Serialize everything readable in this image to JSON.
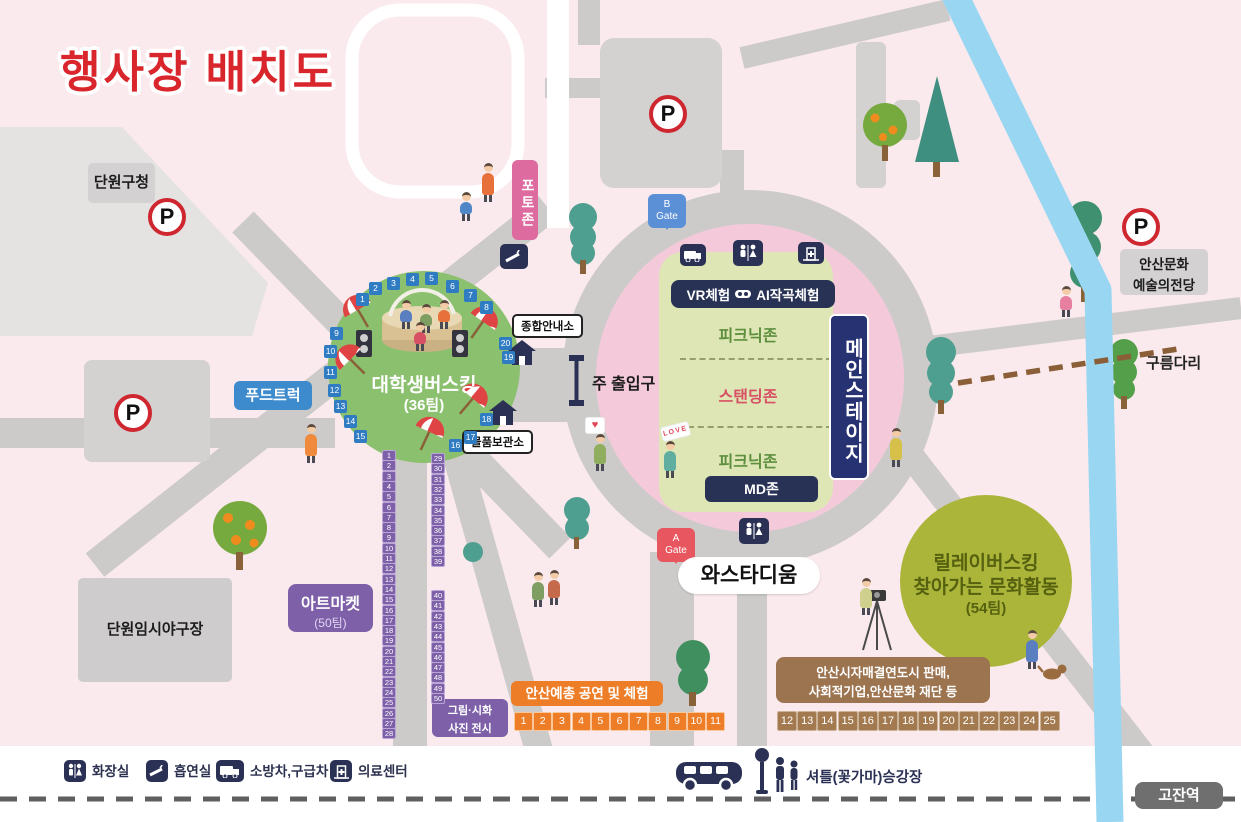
{
  "title": "행사장 배치도",
  "buildings": {
    "district_office": "단원구청",
    "baseball_field": "단원임시야구장",
    "arts_center_line1": "안산문화",
    "arts_center_line2": "예술의전당",
    "gojan_station": "고잔역"
  },
  "parking": {
    "label": "P"
  },
  "gates": {
    "b": {
      "line1": "B",
      "line2": "Gate"
    },
    "a": {
      "line1": "A",
      "line2": "Gate"
    }
  },
  "stadium": {
    "name": "와스타디움",
    "main_stage": "메인스테이지",
    "vr_label_left": "VR체험",
    "vr_label_right": "AI작곡체험",
    "picnic_zone_top": "피크닉존",
    "standing_zone": "스탠딩존",
    "picnic_zone_bottom": "피크닉존",
    "md_zone": "MD존"
  },
  "busking": {
    "name": "대학생버스킹",
    "teams": "(36팀)"
  },
  "relay": {
    "line1": "릴레이버스킹",
    "line2": "찾아가는 문화활동",
    "line3": "(54팀)"
  },
  "facilities": {
    "photo_zone": "포토존",
    "info_booth": "종합안내소",
    "main_entrance": "주 출입구",
    "locker": "물품보관소",
    "food_truck": "푸드트럭",
    "art_market_line1": "아트마켓",
    "art_market_line2": "(50팀)",
    "exhibit_line1": "그림·시화",
    "exhibit_line2": "사진 전시",
    "yechong": "안산예총 공연 및 체험",
    "sister_city_line1": "안산시자매결연도시 판매,",
    "sister_city_line2": "사회적기업,안산문화 재단 등",
    "bridge": "구름다리",
    "shuttle": "셔틀(꽃가마)승강장"
  },
  "signs": {
    "heart": "♥",
    "love": "LOVE"
  },
  "legend": {
    "items": [
      {
        "icon": "toilet-icon",
        "label": "화장실"
      },
      {
        "icon": "smoking-icon",
        "label": "흡연실"
      },
      {
        "icon": "fire-ambulance-icon",
        "label": "소방차,구급차"
      },
      {
        "icon": "medical-center-icon",
        "label": "의료센터"
      }
    ]
  },
  "numbers": {
    "stage_blue": [
      1,
      2,
      3,
      4,
      5,
      6,
      7,
      8,
      9,
      10,
      11,
      12,
      13,
      14,
      15,
      16,
      17,
      18,
      19,
      20
    ],
    "purple_left": [
      1,
      2,
      3,
      4,
      5,
      6,
      7,
      8,
      9,
      10,
      11,
      12,
      13,
      14,
      15,
      16,
      17,
      18,
      19,
      20,
      21,
      22,
      23,
      24,
      25,
      26,
      27,
      28
    ],
    "purple_right_upper": [
      29,
      30,
      31,
      32,
      33,
      34,
      35,
      36,
      37,
      38,
      39
    ],
    "purple_right_lower": [
      40,
      41,
      42,
      43,
      44,
      45,
      46,
      47,
      48,
      49,
      50
    ],
    "orange_row": [
      1,
      2,
      3,
      4,
      5,
      6,
      7,
      8,
      9,
      10,
      11
    ],
    "brown_row": [
      12,
      13,
      14,
      15,
      16,
      17,
      18,
      19,
      20,
      21,
      22,
      23,
      24,
      25
    ]
  },
  "colors": {
    "background_pink": "#fbeaed",
    "road_gray": "#cdcbca",
    "stadium_ring_pink": "#f4cadb",
    "field_green": "#dde6b4",
    "busking_green": "#8bc06f",
    "relay_olive": "#aab53a",
    "navy": "#2b3154",
    "stream_blue": "#99d6f2",
    "title_red": "#d9262c"
  }
}
